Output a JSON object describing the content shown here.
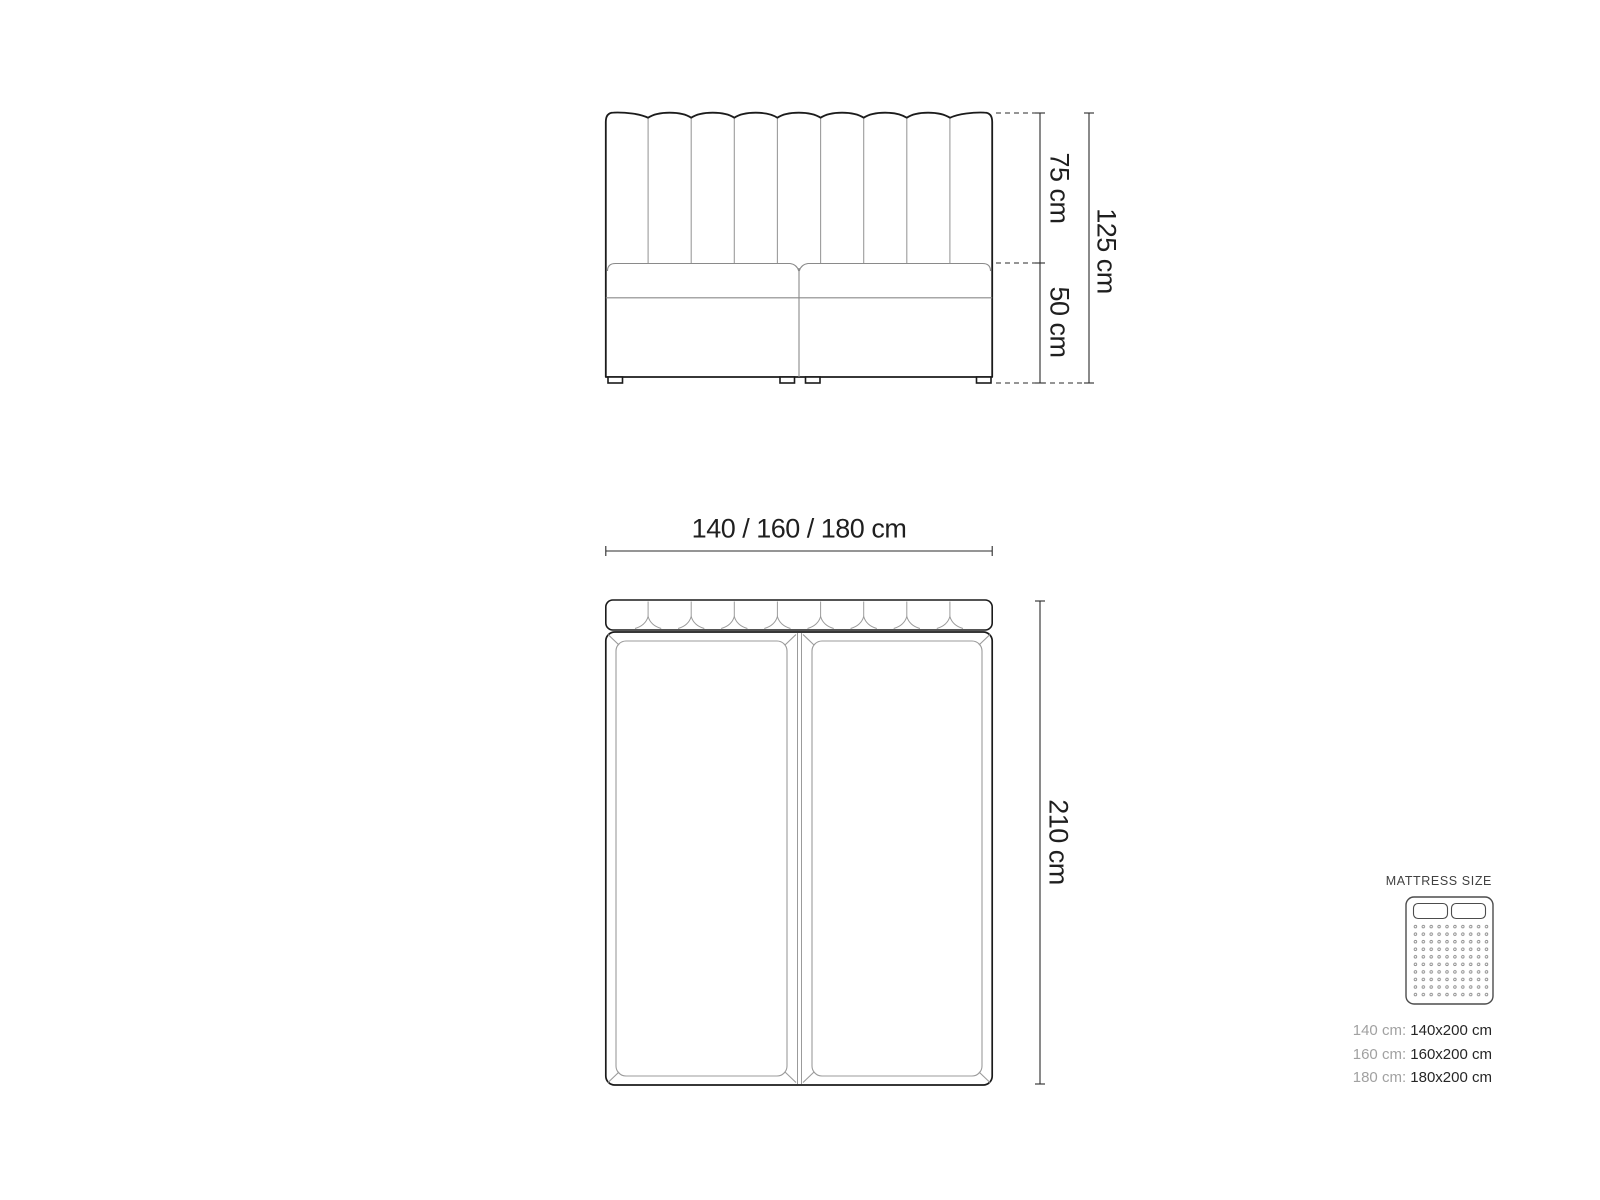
{
  "front_view": {
    "headboard_height": "75 cm",
    "base_height": "50 cm",
    "total_height": "125 cm"
  },
  "top_view": {
    "width_options": "140 / 160 / 180 cm",
    "length": "210 cm"
  },
  "legend": {
    "title": "MATTRESS SIZE",
    "rows": [
      {
        "label": "140 cm:",
        "value": "140x200 cm"
      },
      {
        "label": "160 cm:",
        "value": "160x200 cm"
      },
      {
        "label": "180 cm:",
        "value": "180x200 cm"
      }
    ]
  },
  "colors": {
    "outline": "#1b1b1b",
    "detail_line": "#9b9b9b",
    "dimension_line": "#2b2b2b",
    "label_text": "#1f1f1f",
    "legend_muted": "#a1a1a1",
    "legend_strong": "#262626",
    "background": "#ffffff"
  }
}
